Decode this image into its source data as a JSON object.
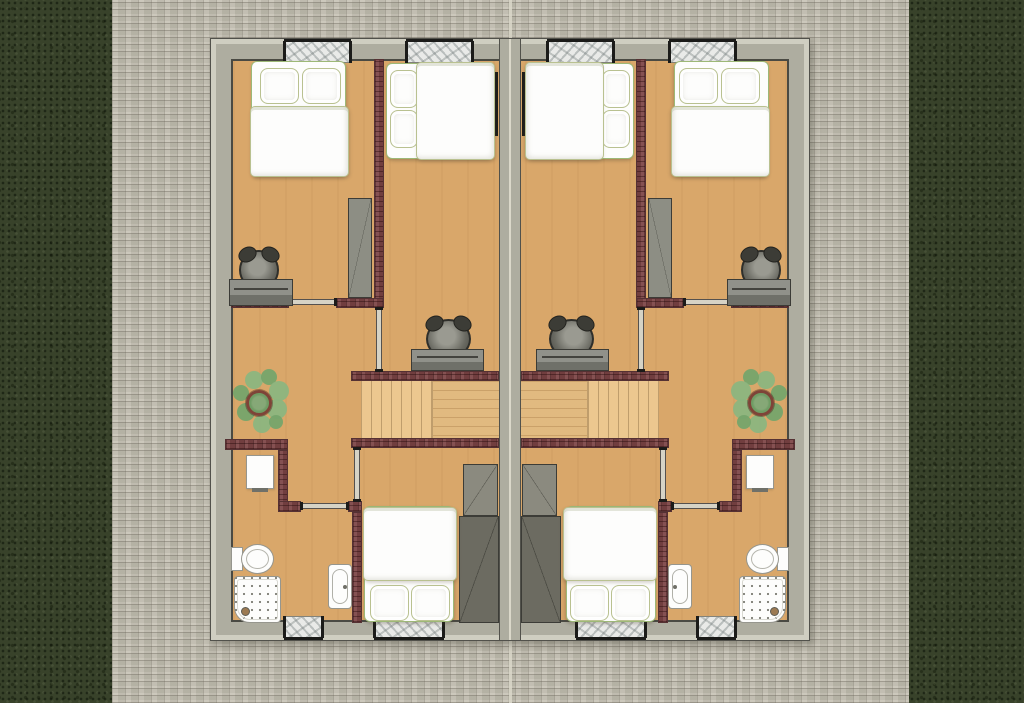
{
  "scene": {
    "type": "architectural-floor-plan",
    "view": "top-down",
    "description": "Upper floor plan of two mirrored semi-detached dwelling units on a brick-paved yard with grass strips along the left and right edges.",
    "units": [
      {
        "name": "left-unit",
        "mirrored": false
      },
      {
        "name": "right-unit",
        "mirrored": true
      }
    ],
    "rooms_per_unit": [
      {
        "name": "front-bedroom",
        "contents": [
          "double-bed",
          "two-pillows",
          "desk",
          "office-chair",
          "wardrobe",
          "window"
        ]
      },
      {
        "name": "middle-bedroom",
        "contents": [
          "double-bed",
          "two-pillows",
          "radiator",
          "window"
        ]
      },
      {
        "name": "landing",
        "contents": [
          "staircase",
          "desk",
          "office-chair",
          "potted-plant"
        ]
      },
      {
        "name": "bathroom",
        "contents": [
          "washbasin-cabinet",
          "toilet",
          "shower-tray",
          "sink",
          "window"
        ]
      },
      {
        "name": "rear-bedroom",
        "contents": [
          "double-bed",
          "two-pillows",
          "wardrobe-two-part",
          "window"
        ]
      }
    ],
    "windows_total": 8,
    "doors_per_unit": 4,
    "staircase": {
      "orientation": "horizontal",
      "treads_visible": 13
    }
  },
  "colors": {
    "grass": "#38422a",
    "paver": "#c6c2b4",
    "seam": "#dbd8ca",
    "wall-light": "#cfcec1",
    "wall-mid": "#aeada0",
    "wall-dark": "#4a4a43",
    "wall-edge": "#51514b",
    "floor": "#d9a76a",
    "brick": "#7c4445",
    "brick-edge": "#553133",
    "wood": "#ecc78f",
    "wood-line": "#bf9d6c",
    "white": "#fdfdfc",
    "bed-edge": "#9db877",
    "desk": "#90918a",
    "desk-dark": "#6f7069",
    "wardrobe": "#8d8e84",
    "wardrobe-light": "#8b8a7f",
    "wardrobe-dark": "#6c6b61",
    "chair-dark": "#2f2f2b",
    "marble": "#e9eae8",
    "leaf": "#8cb580",
    "leaf2": "#76a46c",
    "pot": "#7e4438",
    "fixture": "#96968e",
    "door": "#d6d3c6",
    "black": "#1b1b19"
  }
}
